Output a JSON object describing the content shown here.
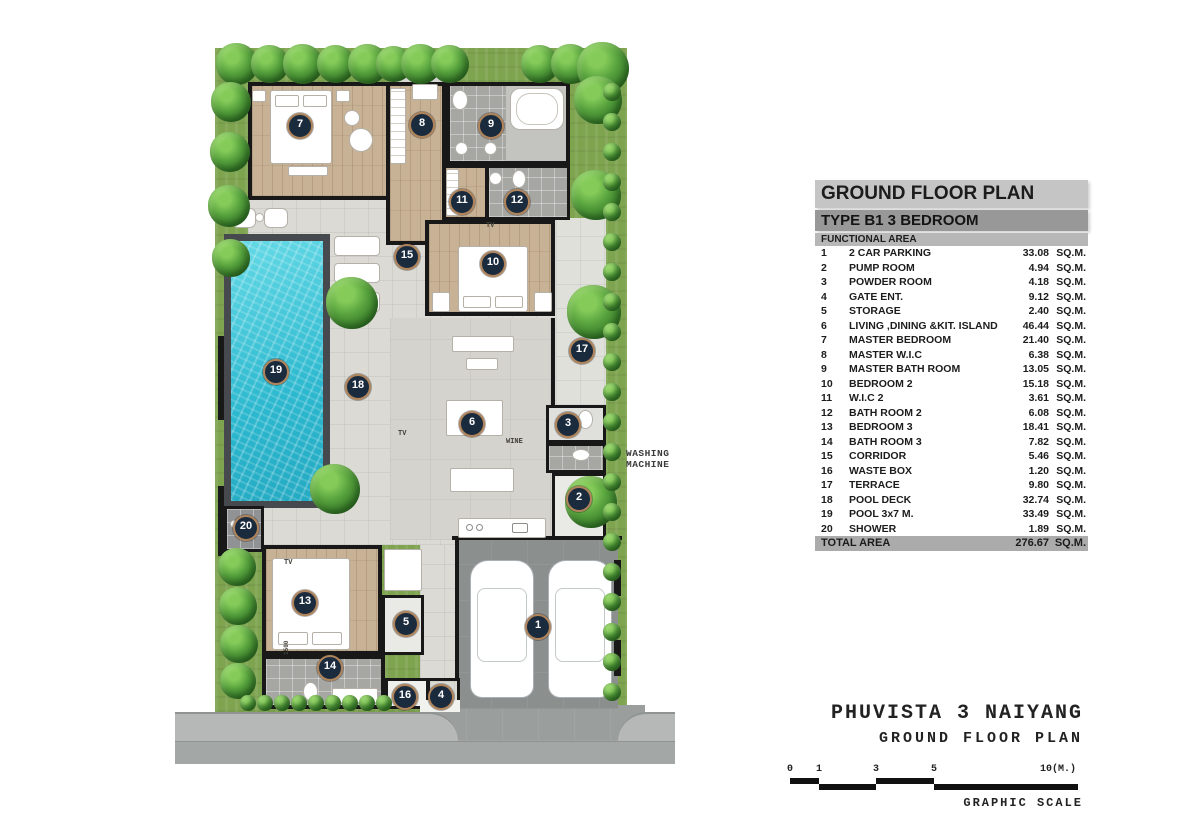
{
  "legend": {
    "title": "GROUND FLOOR PLAN",
    "subtitle": "TYPE B1 3 BEDROOM",
    "column_header": "FUNCTIONAL AREA",
    "unit": "SQ.M.",
    "rows": [
      {
        "no": "1",
        "name": "2 CAR PARKING",
        "area": "33.08"
      },
      {
        "no": "2",
        "name": "PUMP ROOM",
        "area": "4.94"
      },
      {
        "no": "3",
        "name": "POWDER ROOM",
        "area": "4.18"
      },
      {
        "no": "4",
        "name": "GATE ENT.",
        "area": "9.12"
      },
      {
        "no": "5",
        "name": "STORAGE",
        "area": "2.40"
      },
      {
        "no": "6",
        "name": "LIVING ,DINING &KIT. ISLAND",
        "area": "46.44"
      },
      {
        "no": "7",
        "name": "MASTER BEDROOM",
        "area": "21.40"
      },
      {
        "no": "8",
        "name": "MASTER W.I.C",
        "area": "6.38"
      },
      {
        "no": "9",
        "name": "MASTER BATH ROOM",
        "area": "13.05"
      },
      {
        "no": "10",
        "name": "BEDROOM 2",
        "area": "15.18"
      },
      {
        "no": "11",
        "name": "W.I.C 2",
        "area": "3.61"
      },
      {
        "no": "12",
        "name": "BATH ROOM 2",
        "area": "6.08"
      },
      {
        "no": "13",
        "name": "BEDROOM 3",
        "area": "18.41"
      },
      {
        "no": "14",
        "name": "BATH ROOM 3",
        "area": "7.82"
      },
      {
        "no": "15",
        "name": "CORRIDOR",
        "area": "5.46"
      },
      {
        "no": "16",
        "name": "WASTE BOX",
        "area": "1.20"
      },
      {
        "no": "17",
        "name": "TERRACE",
        "area": "9.80"
      },
      {
        "no": "18",
        "name": "POOL DECK",
        "area": "32.74"
      },
      {
        "no": "19",
        "name": "POOL 3x7 M.",
        "area": "33.49"
      },
      {
        "no": "20",
        "name": "SHOWER",
        "area": "1.89"
      }
    ],
    "total": {
      "label": "TOTAL AREA",
      "area": "276.67"
    }
  },
  "title_block": {
    "project": "PHUVISTA 3 NAIYANG",
    "drawing": "GROUND FLOOR PLAN",
    "scale_caption": "GRAPHIC SCALE",
    "scale_labels": [
      "0",
      "1",
      "3",
      "5",
      "10(M.)"
    ]
  },
  "plan": {
    "annotations": {
      "washing_machine_line1": "WASHING",
      "washing_machine_line2": "MACHINE",
      "wine": "WINE",
      "tv": "TV",
      "dim_1500": "1500"
    },
    "colors": {
      "marker_fill": "#1b2b3e",
      "marker_ring": "#b0845a",
      "pool_water": "#2cb8cf",
      "grass": "#7fa450",
      "wood_floor": "#c8b295",
      "wall": "#181818"
    },
    "markers": [
      {
        "no": "1",
        "x": 538,
        "y": 627
      },
      {
        "no": "2",
        "x": 579,
        "y": 499
      },
      {
        "no": "3",
        "x": 568,
        "y": 425
      },
      {
        "no": "4",
        "x": 441,
        "y": 697
      },
      {
        "no": "5",
        "x": 406,
        "y": 624
      },
      {
        "no": "6",
        "x": 472,
        "y": 424
      },
      {
        "no": "7",
        "x": 300,
        "y": 126
      },
      {
        "no": "8",
        "x": 422,
        "y": 125
      },
      {
        "no": "9",
        "x": 491,
        "y": 126
      },
      {
        "no": "10",
        "x": 493,
        "y": 264
      },
      {
        "no": "11",
        "x": 462,
        "y": 202
      },
      {
        "no": "12",
        "x": 517,
        "y": 202
      },
      {
        "no": "13",
        "x": 305,
        "y": 603
      },
      {
        "no": "14",
        "x": 330,
        "y": 668
      },
      {
        "no": "15",
        "x": 407,
        "y": 257
      },
      {
        "no": "16",
        "x": 405,
        "y": 697
      },
      {
        "no": "17",
        "x": 582,
        "y": 351
      },
      {
        "no": "18",
        "x": 358,
        "y": 387
      },
      {
        "no": "19",
        "x": 276,
        "y": 372
      },
      {
        "no": "20",
        "x": 246,
        "y": 528
      }
    ]
  }
}
